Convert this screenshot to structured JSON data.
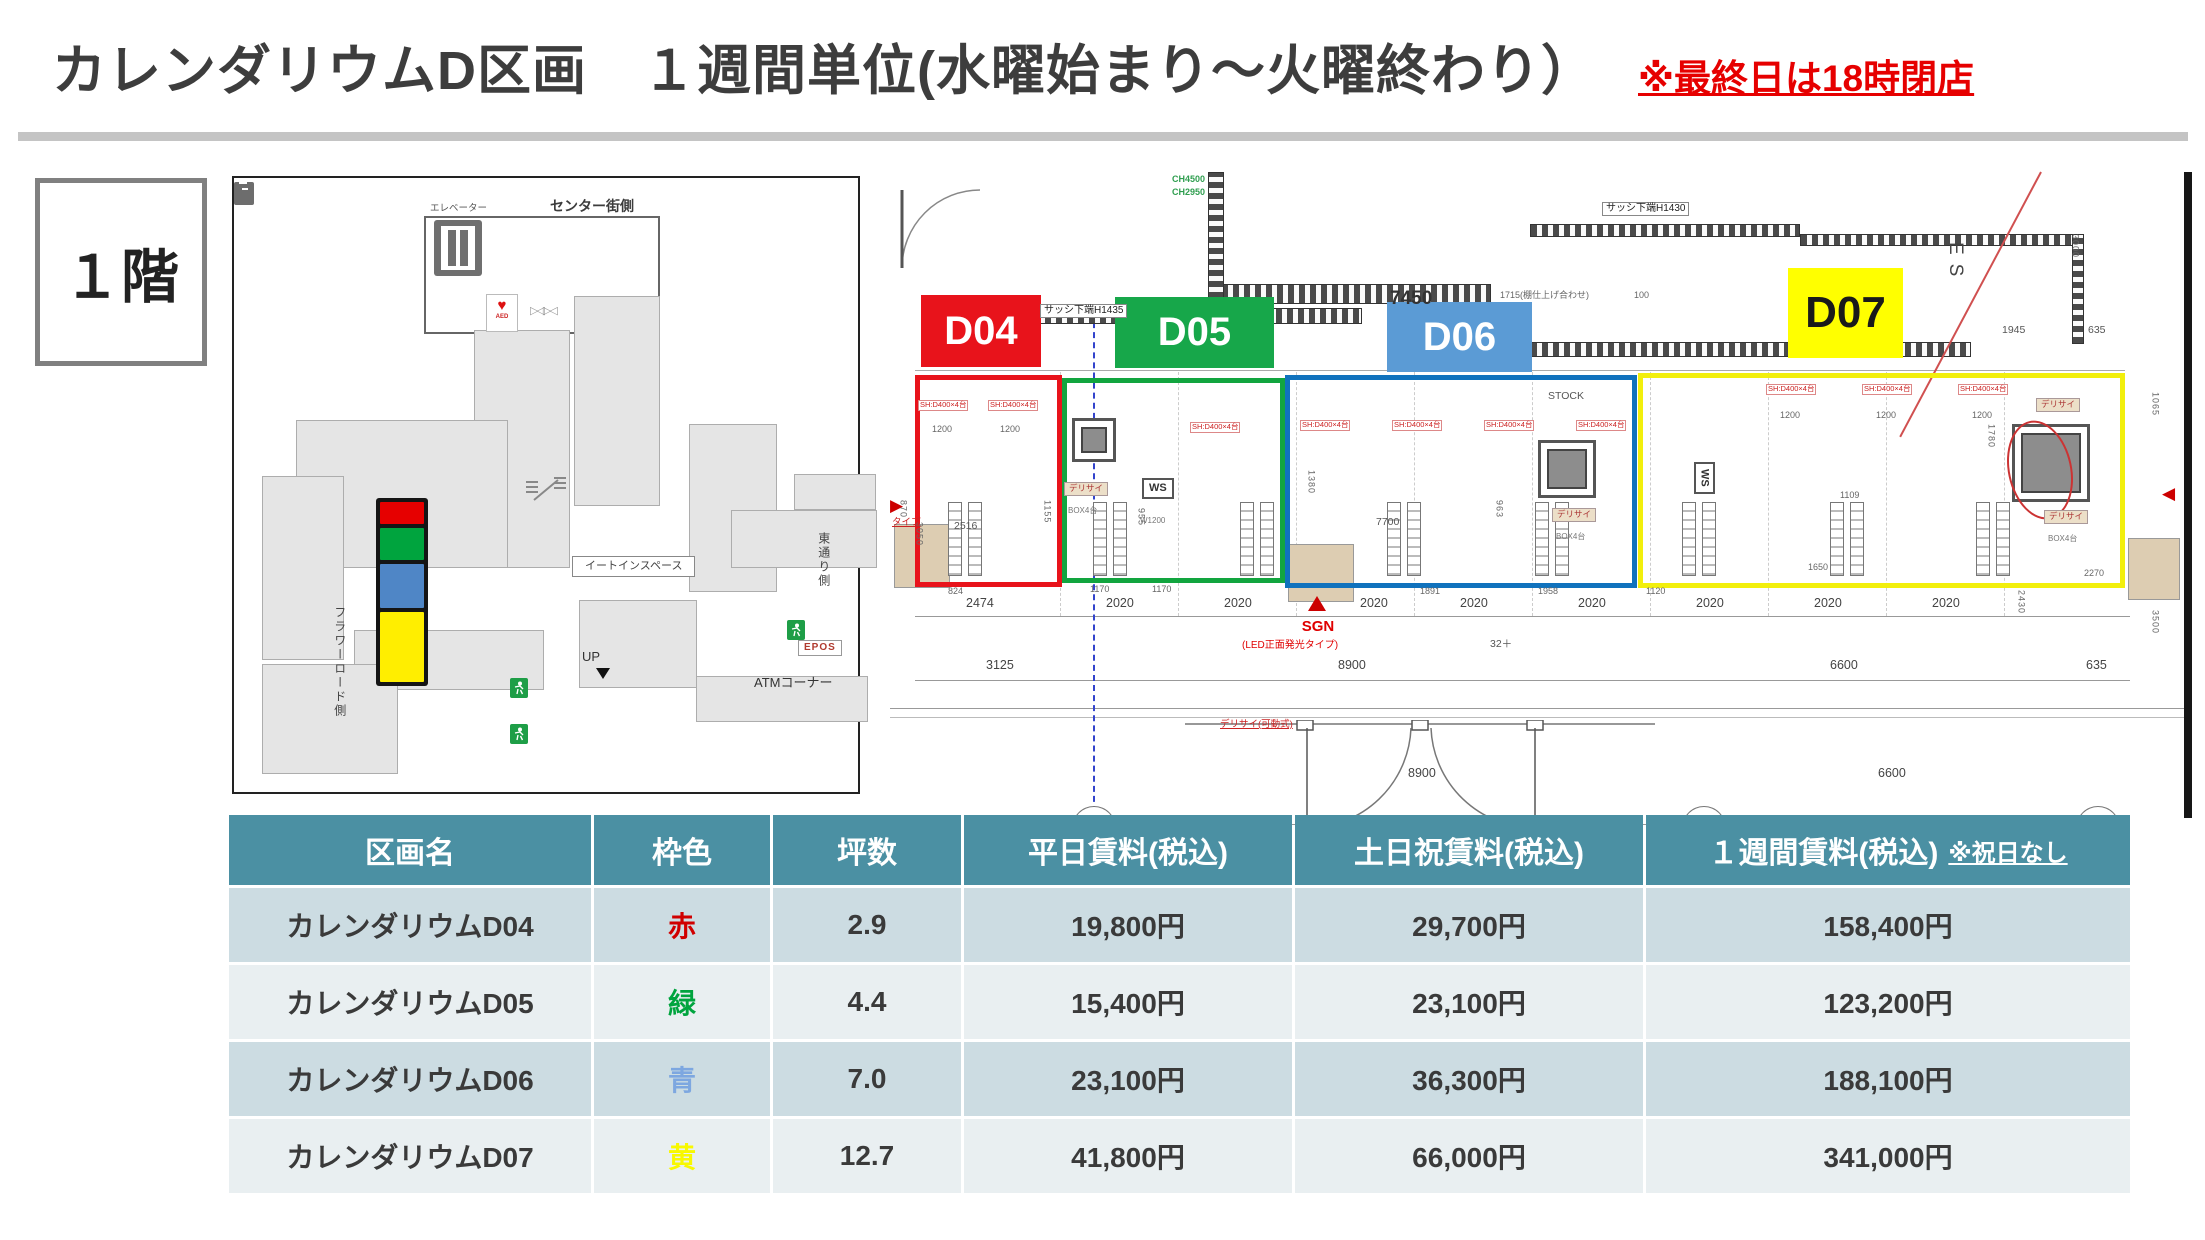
{
  "header": {
    "title": "カレンダリウムD区画　１週間単位(水曜始まり～火曜終わり）",
    "note": "※最終日は18時閉店"
  },
  "floor_badge": "１階",
  "left_map": {
    "annotations": [
      {
        "t": "センター街側",
        "x": 316,
        "y": 20,
        "c": "m13b"
      },
      {
        "t": "エレベーター",
        "x": 196,
        "y": 26,
        "c": "m9"
      },
      {
        "t": "UP",
        "x": 348,
        "y": 472,
        "c": "m12"
      },
      {
        "t": "イートインスペース",
        "x": 338,
        "y": 378,
        "c": "eatbox"
      },
      {
        "t": "ATMコーナー",
        "x": 520,
        "y": 498,
        "c": "m12"
      },
      {
        "t": "EPOS",
        "x": 564,
        "y": 462,
        "c": "epos"
      },
      {
        "t": "フラワーロード側",
        "x": 98,
        "y": 428,
        "c": "m11 vtext"
      },
      {
        "t": "東通り側",
        "x": 582,
        "y": 354,
        "c": "m11 vtext"
      }
    ],
    "stack": {
      "x": 142,
      "y": 320,
      "w": 52,
      "blocks": [
        {
          "name": "zone-d04",
          "color": "#e60000",
          "h": 22
        },
        {
          "name": "zone-d05",
          "color": "#00a43e",
          "h": 32
        },
        {
          "name": "zone-d06",
          "color": "#4f86c6",
          "h": 44
        },
        {
          "name": "zone-d07",
          "color": "#ffee00",
          "h": 70
        }
      ]
    }
  },
  "floor_plan": {
    "zones": [
      {
        "id": "D04",
        "label": "D04",
        "outline": "#e8131b",
        "label_bg": "#e8131b",
        "label_color": "#ffffff",
        "x": 25,
        "y": 203,
        "w": 147,
        "h": 212,
        "lx": 31,
        "ly": 123,
        "lw": 120,
        "lh": 72,
        "lf": 40
      },
      {
        "id": "D05",
        "label": "D05",
        "outline": "#12a53f",
        "label_bg": "#17a74a",
        "label_color": "#ffffff",
        "x": 172,
        "y": 206,
        "w": 223,
        "h": 205,
        "lx": 225,
        "ly": 125,
        "lw": 159,
        "lh": 71,
        "lf": 40
      },
      {
        "id": "D06",
        "label": "D06",
        "outline": "#1072bd",
        "label_bg": "#5b9bd5",
        "label_color": "#ffffff",
        "x": 395,
        "y": 203,
        "w": 352,
        "h": 213,
        "lx": 497,
        "ly": 130,
        "lw": 145,
        "lh": 70,
        "lf": 40
      },
      {
        "id": "D07",
        "label": "D07",
        "outline": "#f2ef0c",
        "label_bg": "#ffff00",
        "label_color": "#1a1a1a",
        "x": 748,
        "y": 201,
        "w": 487,
        "h": 215,
        "lx": 898,
        "ly": 96,
        "lw": 115,
        "lh": 90,
        "lf": 44
      }
    ],
    "annotations": [
      {
        "t": "7450",
        "x": 500,
        "y": 116,
        "c": "a16"
      },
      {
        "t": "サッシ下端H1435",
        "x": 150,
        "y": 132,
        "c": "wall-lbl"
      },
      {
        "t": "サッシ下端H1430",
        "x": 712,
        "y": 30,
        "c": "wall-lbl"
      },
      {
        "t": "CH4500",
        "x": 282,
        "y": 2,
        "c": "grn"
      },
      {
        "t": "CH2950",
        "x": 282,
        "y": 15,
        "c": "grn"
      },
      {
        "t": "1715(棚仕上げ合わせ)",
        "x": 610,
        "y": 118,
        "c": "a9"
      },
      {
        "t": "100",
        "x": 744,
        "y": 118,
        "c": "a9"
      },
      {
        "t": "ES",
        "x": 1054,
        "y": 70,
        "c": "es"
      },
      {
        "t": "1945",
        "x": 1112,
        "y": 152,
        "c": "a10"
      },
      {
        "t": "635",
        "x": 1198,
        "y": 152,
        "c": "a10"
      },
      {
        "t": "3000",
        "x": 1180,
        "y": 62,
        "c": "a9 vt"
      },
      {
        "t": "STOCK",
        "x": 658,
        "y": 218,
        "c": "a10"
      },
      {
        "t": "WS",
        "x": 804,
        "y": 290,
        "c": "ws wsv"
      },
      {
        "t": "WS",
        "x": 252,
        "y": 306,
        "c": "ws"
      },
      {
        "t": "W1200",
        "x": 250,
        "y": 344,
        "c": "a8"
      },
      {
        "t": "SH:D400×4台",
        "x": 28,
        "y": 228,
        "c": "shred"
      },
      {
        "t": "SH:D400×4台",
        "x": 98,
        "y": 228,
        "c": "shred"
      },
      {
        "t": "1200",
        "x": 42,
        "y": 252,
        "c": "a9"
      },
      {
        "t": "1200",
        "x": 110,
        "y": 252,
        "c": "a9"
      },
      {
        "t": "SH:D400×4台",
        "x": 300,
        "y": 250,
        "c": "shred"
      },
      {
        "t": "SH:D400×4台",
        "x": 410,
        "y": 248,
        "c": "shred"
      },
      {
        "t": "SH:D400×4台",
        "x": 502,
        "y": 248,
        "c": "shred"
      },
      {
        "t": "SH:D400×4台",
        "x": 594,
        "y": 248,
        "c": "shred"
      },
      {
        "t": "SH:D400×4台",
        "x": 686,
        "y": 248,
        "c": "shred"
      },
      {
        "t": "SH:D400×4台",
        "x": 876,
        "y": 212,
        "c": "shred"
      },
      {
        "t": "SH:D400×4台",
        "x": 972,
        "y": 212,
        "c": "shred"
      },
      {
        "t": "SH:D400×4台",
        "x": 1068,
        "y": 212,
        "c": "shred"
      },
      {
        "t": "1200",
        "x": 890,
        "y": 238,
        "c": "a9"
      },
      {
        "t": "1200",
        "x": 986,
        "y": 238,
        "c": "a9"
      },
      {
        "t": "1200",
        "x": 1082,
        "y": 238,
        "c": "a9"
      },
      {
        "t": "デリサイ",
        "x": 174,
        "y": 310,
        "c": "chip"
      },
      {
        "t": "BOX4台",
        "x": 178,
        "y": 334,
        "c": "a8"
      },
      {
        "t": "デリサイ",
        "x": 662,
        "y": 336,
        "c": "chip"
      },
      {
        "t": "BOX4台",
        "x": 666,
        "y": 360,
        "c": "a8"
      },
      {
        "t": "デリサイ",
        "x": 1146,
        "y": 226,
        "c": "chip"
      },
      {
        "t": "デリサイ",
        "x": 1154,
        "y": 338,
        "c": "chip"
      },
      {
        "t": "BOX4台",
        "x": 1158,
        "y": 362,
        "c": "a8"
      },
      {
        "t": "2516",
        "x": 64,
        "y": 348,
        "c": "a10"
      },
      {
        "t": "824",
        "x": 58,
        "y": 414,
        "c": "a9"
      },
      {
        "t": "1155",
        "x": 152,
        "y": 328,
        "c": "a9 vt"
      },
      {
        "t": "870",
        "x": 8,
        "y": 328,
        "c": "a9 vt"
      },
      {
        "t": "3050",
        "x": 24,
        "y": 350,
        "c": "a9 vt"
      },
      {
        "t": "1170",
        "x": 200,
        "y": 412,
        "c": "a9"
      },
      {
        "t": "1170",
        "x": 262,
        "y": 412,
        "c": "a9"
      },
      {
        "t": "955",
        "x": 246,
        "y": 336,
        "c": "a9 vt"
      },
      {
        "t": "1380",
        "x": 416,
        "y": 298,
        "c": "a9 vt"
      },
      {
        "t": "7700",
        "x": 486,
        "y": 344,
        "c": "a10"
      },
      {
        "t": "1891",
        "x": 530,
        "y": 414,
        "c": "a9"
      },
      {
        "t": "1958",
        "x": 648,
        "y": 414,
        "c": "a9"
      },
      {
        "t": "963",
        "x": 604,
        "y": 328,
        "c": "a9 vt"
      },
      {
        "t": "1109",
        "x": 950,
        "y": 318,
        "c": "a9"
      },
      {
        "t": "1120",
        "x": 756,
        "y": 414,
        "c": "a9"
      },
      {
        "t": "1650",
        "x": 918,
        "y": 390,
        "c": "a9"
      },
      {
        "t": "2270",
        "x": 1194,
        "y": 396,
        "c": "a9"
      },
      {
        "t": "1780",
        "x": 1096,
        "y": 252,
        "c": "a9 vt"
      },
      {
        "t": "2430",
        "x": 1126,
        "y": 418,
        "c": "a9 vt"
      },
      {
        "t": "3500",
        "x": 1260,
        "y": 438,
        "c": "a9 vt"
      },
      {
        "t": "1065",
        "x": 1260,
        "y": 220,
        "c": "a9 vt"
      },
      {
        "t": "2474",
        "x": 76,
        "y": 424,
        "c": "dim"
      },
      {
        "t": "2020",
        "x": 216,
        "y": 424,
        "c": "dim"
      },
      {
        "t": "2020",
        "x": 334,
        "y": 424,
        "c": "dim"
      },
      {
        "t": "2020",
        "x": 470,
        "y": 424,
        "c": "dim"
      },
      {
        "t": "2020",
        "x": 570,
        "y": 424,
        "c": "dim"
      },
      {
        "t": "2020",
        "x": 688,
        "y": 424,
        "c": "dim"
      },
      {
        "t": "2020",
        "x": 806,
        "y": 424,
        "c": "dim"
      },
      {
        "t": "2020",
        "x": 924,
        "y": 424,
        "c": "dim"
      },
      {
        "t": "2020",
        "x": 1042,
        "y": 424,
        "c": "dim"
      },
      {
        "t": "SGN",
        "x": 398,
        "y": 446,
        "c": "sgn"
      },
      {
        "t": "(LED正面発光タイプ)",
        "x": 352,
        "y": 468,
        "c": "sgnsub"
      },
      {
        "t": "3125",
        "x": 96,
        "y": 486,
        "c": "dim"
      },
      {
        "t": "8900",
        "x": 448,
        "y": 486,
        "c": "dim"
      },
      {
        "t": "32＋",
        "x": 600,
        "y": 466,
        "c": "a10"
      },
      {
        "t": "6600",
        "x": 940,
        "y": 486,
        "c": "dim"
      },
      {
        "t": "635",
        "x": 1196,
        "y": 486,
        "c": "dim"
      },
      {
        "t": "デリサイ(可動式)",
        "x": 330,
        "y": 548,
        "c": "redsm"
      },
      {
        "t": "タイプ",
        "x": 2,
        "y": 346,
        "c": "redsm"
      },
      {
        "t": "8900",
        "x": 518,
        "y": 594,
        "c": "dim"
      },
      {
        "t": "6600",
        "x": 988,
        "y": 594,
        "c": "dim"
      }
    ]
  },
  "table": {
    "headers": [
      "区画名",
      "枠色",
      "坪数",
      "平日賃料(税込)",
      "土日祝賃料(税込)",
      "１週間賃料(税込)"
    ],
    "header_note": "※祝日なし",
    "rows": [
      {
        "name": "カレンダリウムD04",
        "color_label": "赤",
        "color": "#d00000",
        "tsubo": "2.9",
        "weekday": "19,800円",
        "weekend": "29,700円",
        "week": "158,400円"
      },
      {
        "name": "カレンダリウムD05",
        "color_label": "緑",
        "color": "#00a43e",
        "tsubo": "4.4",
        "weekday": "15,400円",
        "weekend": "23,100円",
        "week": "123,200円"
      },
      {
        "name": "カレンダリウムD06",
        "color_label": "青",
        "color": "#7da7e0",
        "tsubo": "7.0",
        "weekday": "23,100円",
        "weekend": "36,300円",
        "week": "188,100円"
      },
      {
        "name": "カレンダリウムD07",
        "color_label": "黄",
        "color": "#f8f800",
        "tsubo": "12.7",
        "weekday": "41,800円",
        "weekend": "66,000円",
        "week": "341,000円"
      }
    ]
  }
}
